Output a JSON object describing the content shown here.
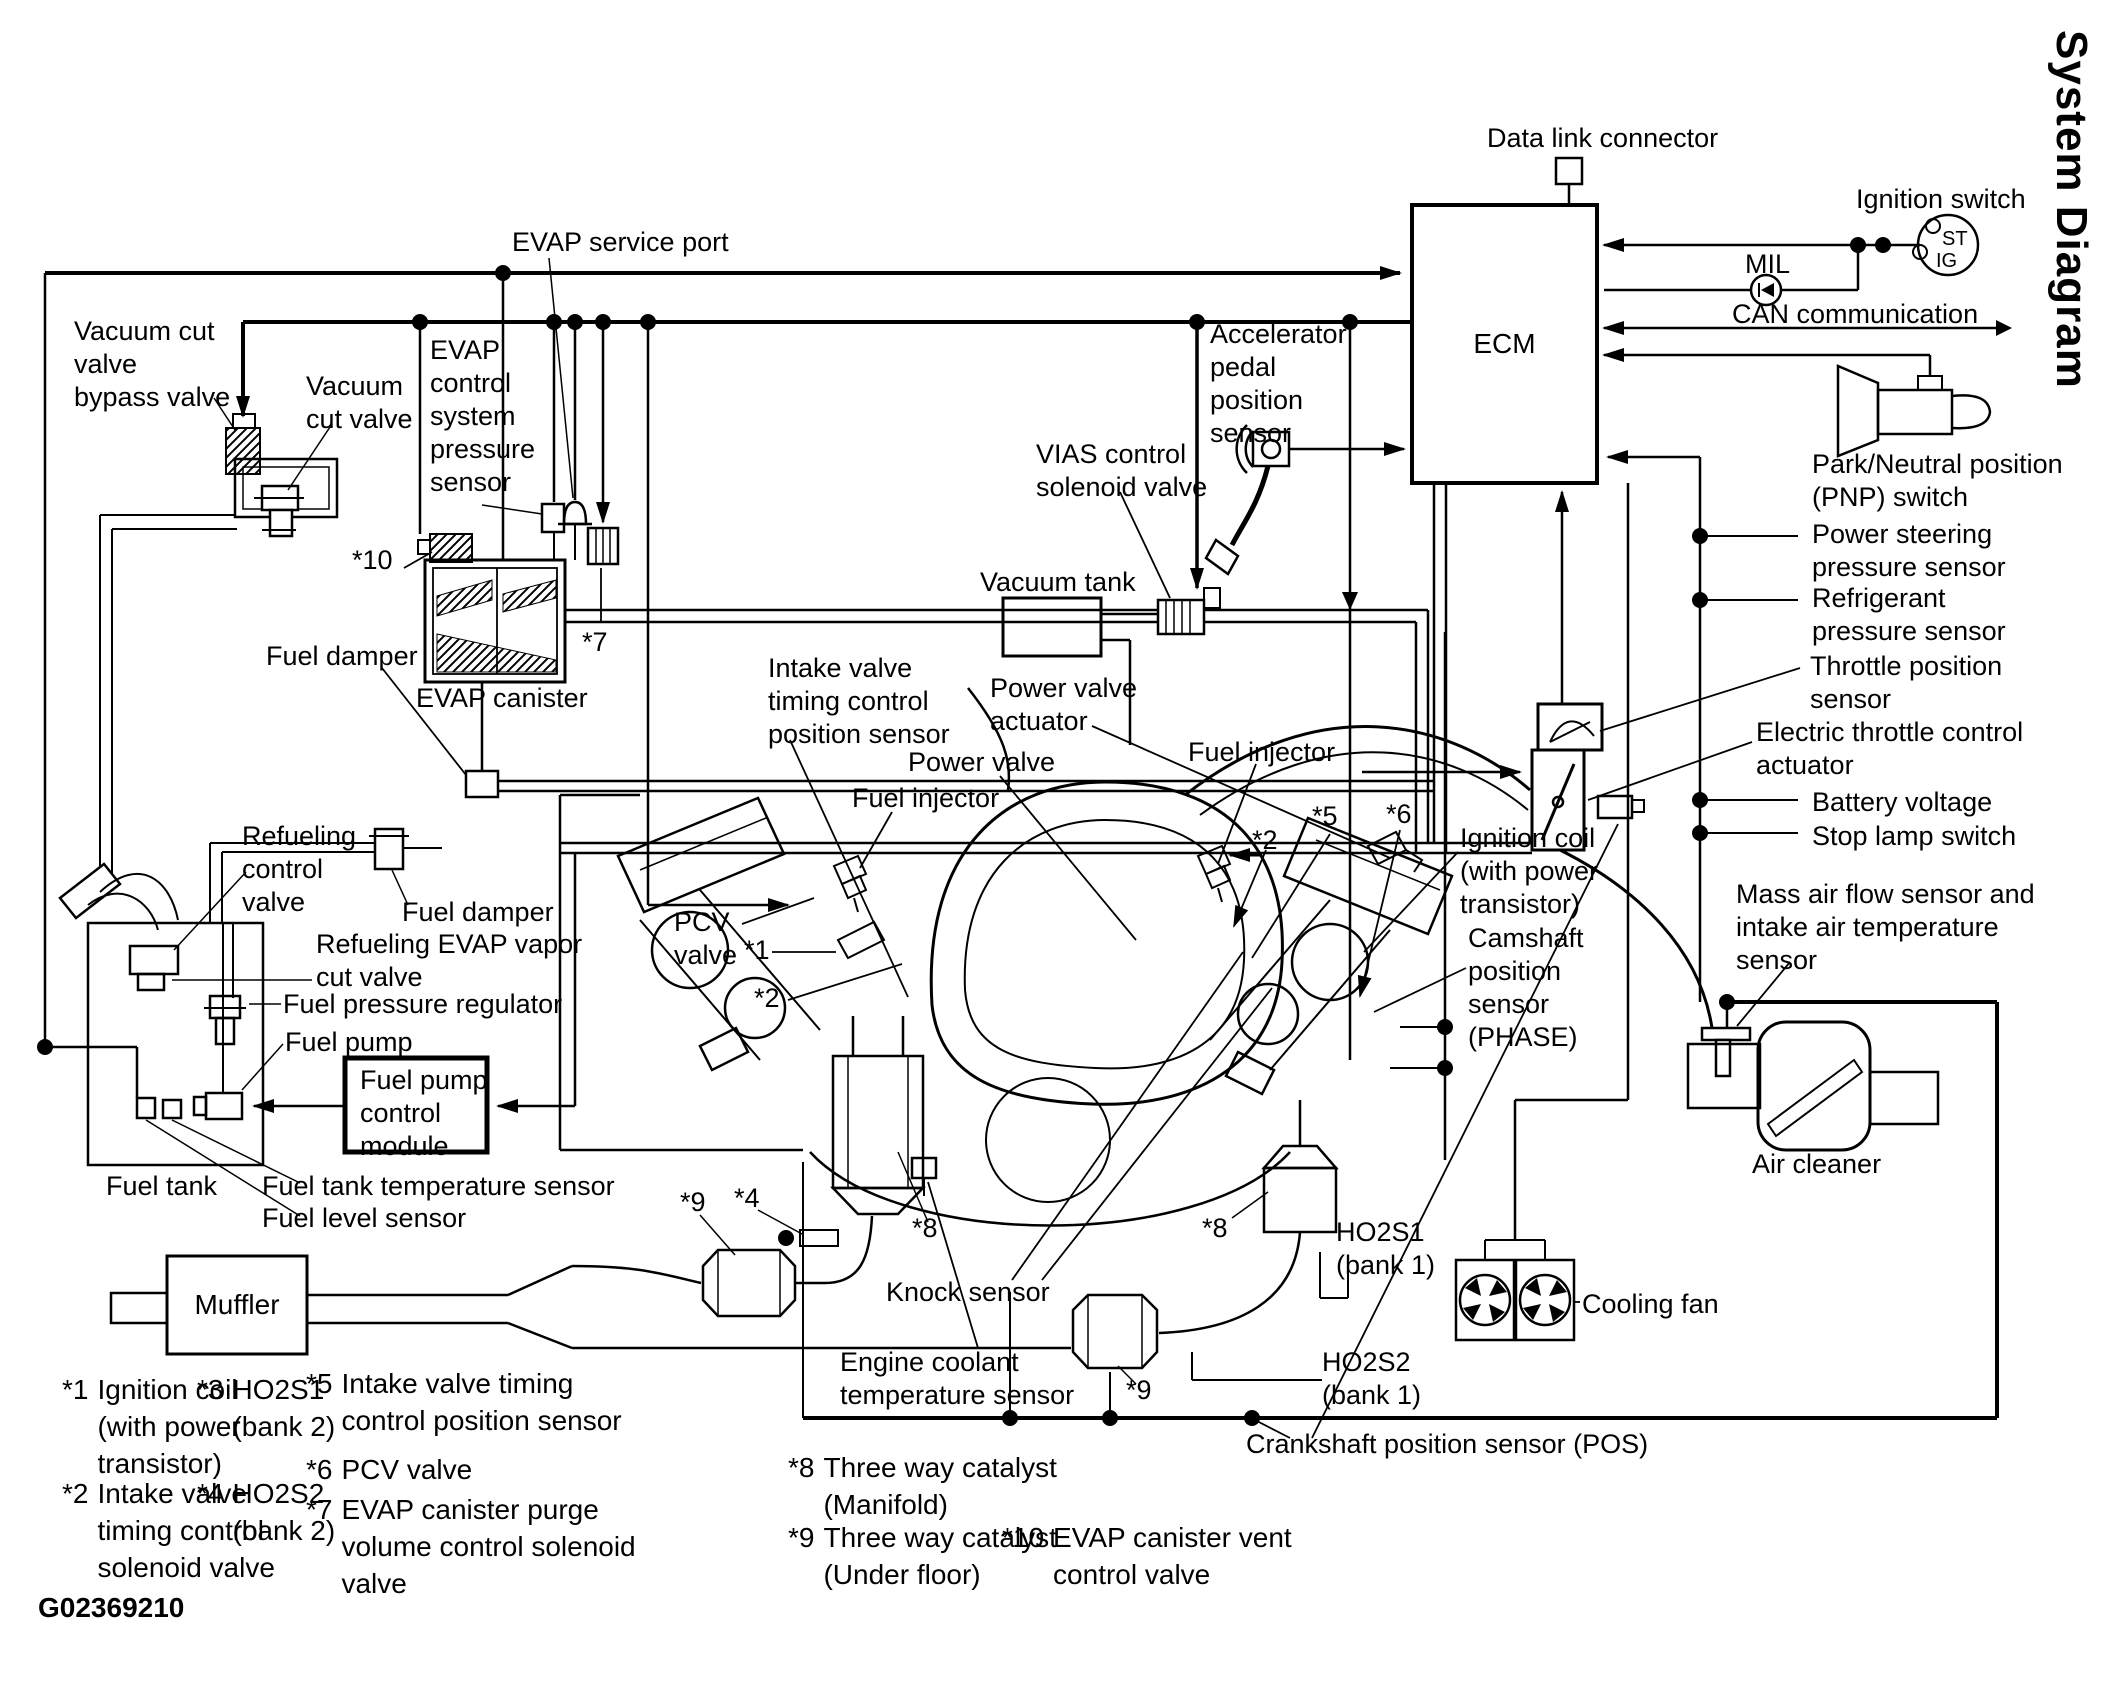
{
  "title": "System Diagram",
  "figure_code": "G02369210",
  "ecm": {
    "label": "ECM"
  },
  "ignition_switch_terminals": {
    "st": "ST",
    "ig": "IG"
  },
  "labels": {
    "data_link_connector": "Data link connector",
    "ignition_switch": "Ignition switch",
    "mil": "MIL",
    "can_communication": "CAN communication",
    "park_neutral": "Park/Neutral position\n(PNP) switch",
    "power_steering": "Power steering\npressure sensor",
    "refrigerant": "Refrigerant\npressure sensor",
    "throttle_position": "Throttle position\nsensor",
    "electric_throttle": "Electric throttle control\nactuator",
    "battery_voltage": "Battery voltage",
    "stop_lamp": "Stop lamp switch",
    "mass_air_flow": "Mass air flow sensor and\nintake air temperature\nsensor",
    "air_cleaner": "Air cleaner",
    "accelerator": "Accelerator\npedal\nposition\nsensor",
    "evap_service_port": "EVAP service port",
    "vacuum_cut_bypass": "Vacuum cut\nvalve\nbypass valve",
    "vacuum_cut_valve": "Vacuum\ncut valve",
    "evap_pressure_sensor": "EVAP\ncontrol\nsystem\npressure\nsensor",
    "vias": "VIAS control\nsolenoid valve",
    "vacuum_tank": "Vacuum tank",
    "evap_canister": "EVAP canister",
    "fuel_damper_upper": "Fuel damper",
    "fuel_damper_lower": "Fuel damper",
    "refueling_control_valve": "Refueling\ncontrol\nvalve",
    "refueling_evap": "Refueling EVAP vapor\ncut valve",
    "fuel_pressure_regulator": "Fuel pressure regulator",
    "fuel_pump": "Fuel pump",
    "fpcm": "Fuel pump\ncontrol\nmodule",
    "fuel_tank": "Fuel tank",
    "fuel_tank_temp": "Fuel tank temperature sensor",
    "fuel_level": "Fuel level sensor",
    "muffler": "Muffler",
    "intake_valve_pos": "Intake valve\ntiming control\nposition sensor",
    "power_valve_actuator": "Power valve\nactuator",
    "power_valve": "Power valve",
    "fuel_injector_left": "Fuel injector",
    "fuel_injector_right": "Fuel injector",
    "pcv_valve": "PCV\nvalve",
    "ignition_coil": "Ignition coil\n(with power\ntransistor)",
    "camshaft": "Camshaft\nposition\nsensor\n(PHASE)",
    "knock_sensor": "Knock sensor",
    "engine_coolant": "Engine coolant\ntemperature sensor",
    "ho2s1_bank1": "HO2S1\n(bank 1)",
    "ho2s2_bank1": "HO2S2\n(bank 1)",
    "cooling_fan": "Cooling fan",
    "crankshaft": "Crankshaft position sensor (POS)",
    "star1": "*1",
    "star2_left": "*2",
    "star2_right": "*2",
    "star4": "*4",
    "star5": "*5",
    "star6": "*6",
    "star7": "*7",
    "star8_left": "*8",
    "star8_right": "*8",
    "star9_left": "*9",
    "star9_right": "*9",
    "star10": "*10"
  },
  "footnotes": [
    {
      "marker": "*1",
      "text": "Ignition coil\n(with power\ntransistor)"
    },
    {
      "marker": "*2",
      "text": "Intake valve\ntiming control\nsolenoid valve"
    },
    {
      "marker": "*3",
      "text": "HO2S1\n(bank 2)"
    },
    {
      "marker": "*4",
      "text": "HO2S2\n(bank 2)"
    },
    {
      "marker": "*5",
      "text": "Intake valve timing\ncontrol position sensor"
    },
    {
      "marker": "*6",
      "text": "PCV valve"
    },
    {
      "marker": "*7",
      "text": "EVAP canister purge\nvolume control solenoid\nvalve"
    },
    {
      "marker": "*8",
      "text": "Three way catalyst\n(Manifold)"
    },
    {
      "marker": "*9",
      "text": "Three way catalyst\n(Under floor)"
    },
    {
      "marker": "*10",
      "text": "EVAP canister vent\ncontrol valve"
    }
  ]
}
